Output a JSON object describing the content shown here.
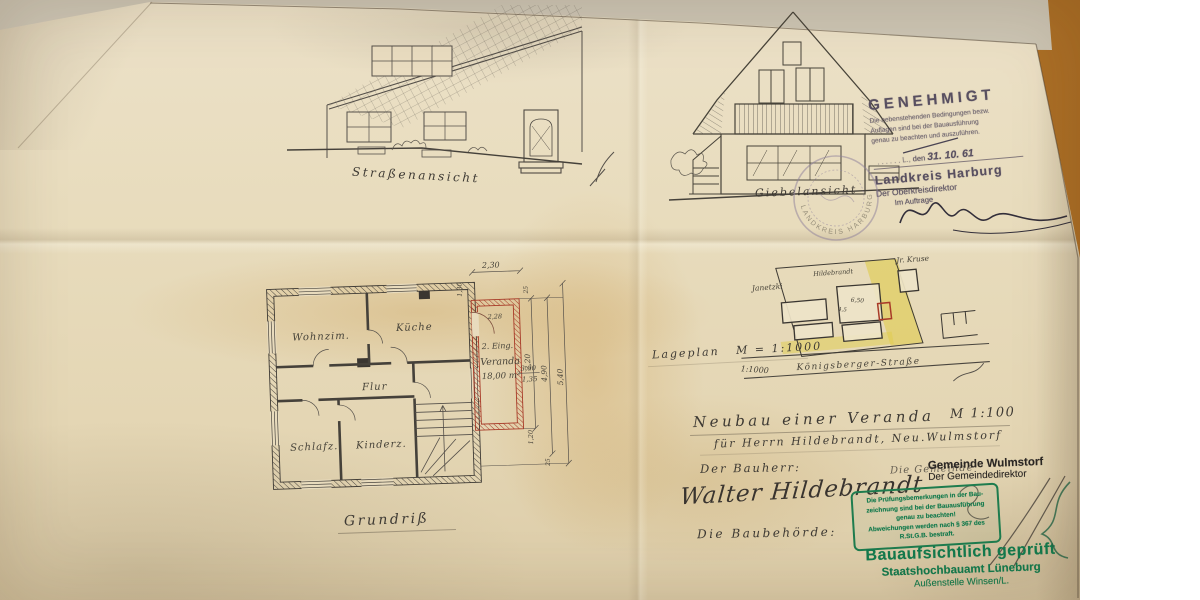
{
  "colors": {
    "desk_wood": "#b57a2e",
    "paper": "#e8dcbd",
    "pencil": "#55504a",
    "new_construction_red": "#a83b28",
    "site_highlight_yellow": "#e0cb4b",
    "approval_stamp_purple": "#584f60",
    "review_stamp_green": "#137a4d"
  },
  "elevations": {
    "street_label": "Straßenansicht",
    "gable_label": "Giebelansicht",
    "plan_label": "Grundriß"
  },
  "floor_plan": {
    "rooms": {
      "living": "Wohnzim.",
      "kitchen": "Küche",
      "hall": "Flur",
      "bedroom": "Schlafz.",
      "children": "Kinderz."
    },
    "veranda": {
      "entrance": "2. Eing.",
      "name": "Veranda",
      "area": "18,00 m²",
      "frac_num": "3,00",
      "frac_den": "1,35"
    },
    "dims": {
      "top": "2,30",
      "left_a": "1,30",
      "left_b": "2,28",
      "small_top": "25",
      "r1": "2,20",
      "r2": "4,90",
      "r3": "5,40",
      "small_bottom": "25",
      "bottom": "1,20"
    }
  },
  "site_plan": {
    "label_name": "Lageplan",
    "label_scale": "M = 1:1000",
    "inner_scale": "1:1000",
    "street": "Königsberger-Straße",
    "owner": "Hildebrandt",
    "neighbor_left": "Janetzki",
    "neighbor_top": "Jr. Kruse",
    "dim_a": "6,50",
    "dim_b": "4,5"
  },
  "title_block": {
    "title": "Neubau einer Veranda",
    "scale": "M 1:100",
    "for_line": "für Herrn Hildebrandt, Neu.Wulmstorf",
    "builder_label": "Der Bauherr:",
    "builder_signature": "Walter Hildebrandt",
    "authority_label": "Die Baubehörde:",
    "municipality_note": "Die Gemeinde"
  },
  "approval_stamp": {
    "title": "GENEHMIGT",
    "line1": "Die nebenstehenden Bedingungen bezw.",
    "line2": "Auflagen sind bei der Bauausführung",
    "line3": "genau zu beachten und auszuführen.",
    "den": "den",
    "date": "31. 10. 61",
    "authority": "Landkreis Harburg",
    "officer": "Der Oberkreisdirektor",
    "by_order": "Im Auftrage",
    "seal_text": "LANDKREIS HARBURG"
  },
  "municipality_stamp": {
    "line1": "Gemeinde Wulmstorf",
    "line2": "Der Gemeindedirektor"
  },
  "review_box_stamp": {
    "line1": "Die Prüfungsbemerkungen in der Bau-",
    "line2": "zeichnung sind bei der Bauausführung",
    "line3": "genau zu beachten!",
    "line4": "Abweichungen werden nach § 367 des",
    "line5": "R.St.G.B. bestraft."
  },
  "approved_stamp": {
    "line1": "Bauaufsichtlich geprüft",
    "line2": "Staatshochbauamt Lüneburg",
    "line3": "Außenstelle Winsen/L."
  }
}
